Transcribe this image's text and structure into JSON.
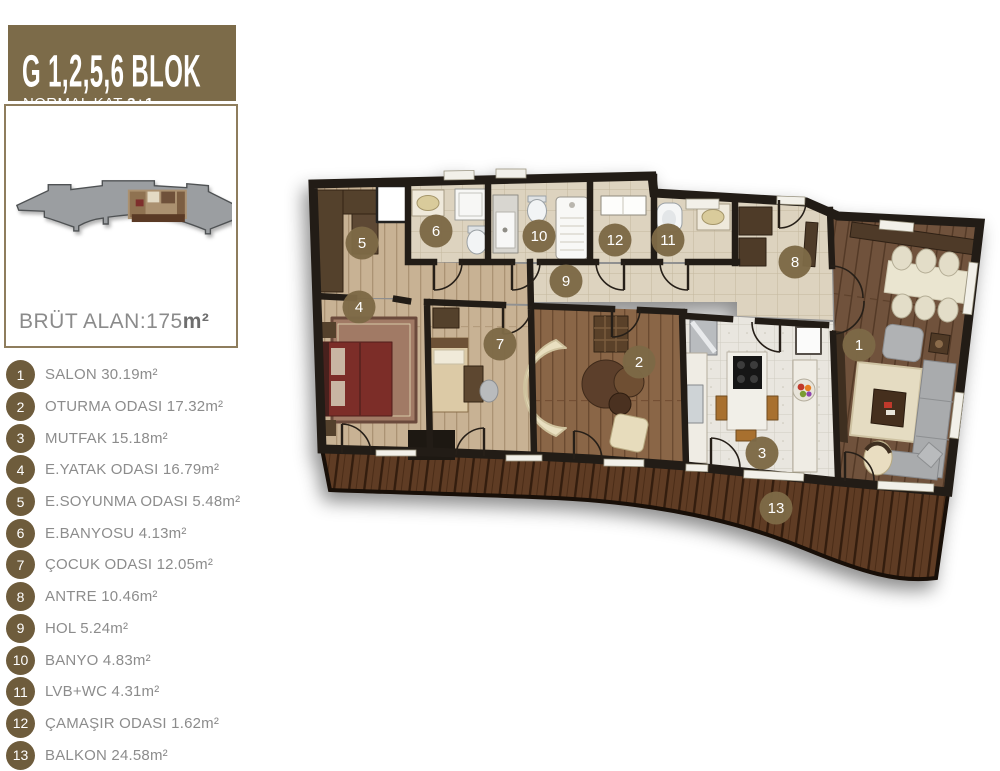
{
  "header": {
    "title": "G 1,2,5,6 BLOK",
    "subtitle_prefix": "NORMAL KAT",
    "subtitle_bold": "3+1"
  },
  "overview": {
    "area_label_prefix": "BRÜT ALAN:175",
    "area_unit": "m²"
  },
  "legend": {
    "items": [
      {
        "num": "1",
        "label": "SALON 30.19m²"
      },
      {
        "num": "2",
        "label": "OTURMA ODASI 17.32m²"
      },
      {
        "num": "3",
        "label": "MUTFAK 15.18m²"
      },
      {
        "num": "4",
        "label": "E.YATAK ODASI 16.79m²"
      },
      {
        "num": "5",
        "label": "E.SOYUNMA ODASI 5.48m²"
      },
      {
        "num": "6",
        "label": "E.BANYOSU 4.13m²"
      },
      {
        "num": "7",
        "label": "ÇOCUK ODASI 12.05m²"
      },
      {
        "num": "8",
        "label": "ANTRE 10.46m²"
      },
      {
        "num": "9",
        "label": "HOL 5.24m²"
      },
      {
        "num": "10",
        "label": "BANYO 4.83m²"
      },
      {
        "num": "11",
        "label": "LVB+WC 4.31m²"
      },
      {
        "num": "12",
        "label": "ÇAMAŞIR ODASI 1.62m²"
      },
      {
        "num": "13",
        "label": "BALKON 24.58m²"
      }
    ]
  },
  "plan": {
    "markers": [
      {
        "num": "1",
        "x": 859,
        "y": 345
      },
      {
        "num": "2",
        "x": 639,
        "y": 362
      },
      {
        "num": "3",
        "x": 762,
        "y": 453
      },
      {
        "num": "4",
        "x": 359,
        "y": 307
      },
      {
        "num": "5",
        "x": 362,
        "y": 243
      },
      {
        "num": "6",
        "x": 436,
        "y": 231
      },
      {
        "num": "7",
        "x": 500,
        "y": 344
      },
      {
        "num": "8",
        "x": 795,
        "y": 262
      },
      {
        "num": "9",
        "x": 566,
        "y": 281
      },
      {
        "num": "10",
        "x": 539,
        "y": 236
      },
      {
        "num": "11",
        "x": 668,
        "y": 240
      },
      {
        "num": "12",
        "x": 615,
        "y": 240
      },
      {
        "num": "13",
        "x": 776,
        "y": 508
      }
    ]
  },
  "colors": {
    "header_bg": "#7c6b49",
    "panel_border": "#8e7d5d",
    "legend_circle": "#6e5c3c",
    "legend_text": "#8c8c8c",
    "area_text": "#8b8b8b",
    "marker": "#7d6946"
  }
}
